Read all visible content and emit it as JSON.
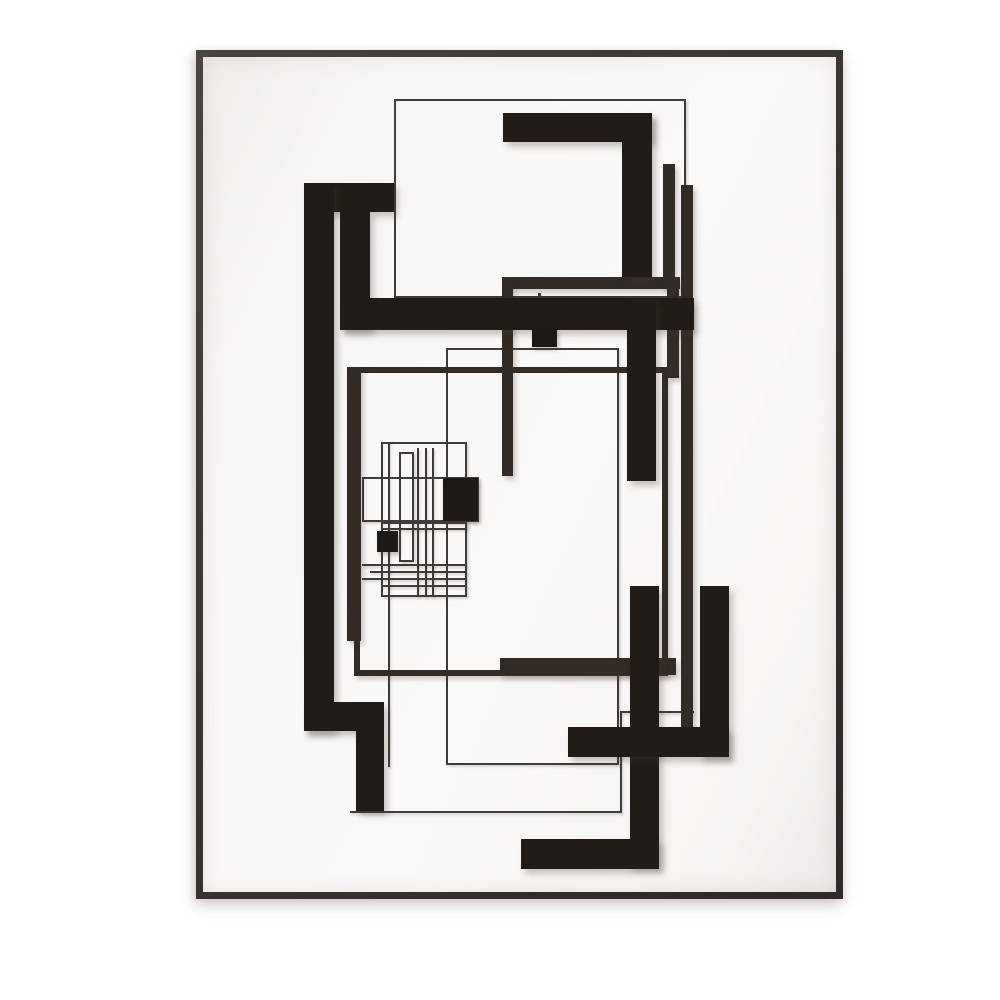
{
  "artwork": {
    "palette": {
      "background": "#ffffff",
      "matte": "#f8f6f4",
      "frame": "#3d3834",
      "thick": "#211c18",
      "medium": "#322b26",
      "thin": "#3f3b39",
      "accent_square": "#1e1915"
    },
    "frame": {
      "x": 196,
      "y": 50,
      "width": 647,
      "height": 849,
      "thickness": 7
    },
    "shapes": [
      {
        "name": "outline-square-top",
        "kind": "thin-outline",
        "x": 394,
        "y": 99,
        "w": 292,
        "h": 199,
        "t": 2
      },
      {
        "name": "outline-rect-center",
        "kind": "thin-outline",
        "x": 446,
        "y": 348,
        "w": 173,
        "h": 417,
        "t": 2
      },
      {
        "name": "cluster-outer-rect",
        "kind": "thin-outline",
        "x": 381,
        "y": 442,
        "w": 86,
        "h": 88,
        "t": 2
      },
      {
        "name": "cluster-tall-rect",
        "kind": "thin-outline",
        "x": 399,
        "y": 452,
        "w": 15,
        "h": 110,
        "t": 2
      },
      {
        "name": "cluster-wide-rect",
        "kind": "thin-outline",
        "x": 362,
        "y": 477,
        "w": 117,
        "h": 45,
        "t": 2
      },
      {
        "name": "cluster-lower-rect",
        "kind": "thin-outline",
        "x": 381,
        "y": 522,
        "w": 86,
        "h": 75,
        "t": 2
      },
      {
        "name": "thin-line-bottom",
        "kind": "thin-line",
        "x": 350,
        "y": 811,
        "w": 272,
        "h": 2
      },
      {
        "name": "thin-line-right-vertical",
        "kind": "thin-line",
        "x": 620,
        "y": 712,
        "w": 2,
        "h": 100
      },
      {
        "name": "thin-line-right-horizontal",
        "kind": "thin-line",
        "x": 620,
        "y": 711,
        "w": 74,
        "h": 2
      },
      {
        "name": "thin-line-left-vertical",
        "kind": "thin-line",
        "x": 388,
        "y": 442,
        "w": 2,
        "h": 325
      },
      {
        "name": "thin-connector-top",
        "kind": "thin-line",
        "x": 538,
        "y": 293,
        "w": 3,
        "h": 36
      },
      {
        "name": "cluster-vline-1",
        "kind": "thin-line",
        "x": 417,
        "y": 448,
        "w": 2,
        "h": 149
      },
      {
        "name": "cluster-vline-2",
        "kind": "thin-line",
        "x": 425,
        "y": 448,
        "w": 2,
        "h": 149
      },
      {
        "name": "cluster-vline-3",
        "kind": "thin-line",
        "x": 432,
        "y": 448,
        "w": 2,
        "h": 149
      },
      {
        "name": "cluster-hline-1",
        "kind": "thin-line",
        "x": 362,
        "y": 564,
        "w": 105,
        "h": 2
      },
      {
        "name": "cluster-hline-2",
        "kind": "thin-line",
        "x": 370,
        "y": 571,
        "w": 97,
        "h": 2
      },
      {
        "name": "cluster-hline-3",
        "kind": "thin-line",
        "x": 362,
        "y": 578,
        "w": 105,
        "h": 2
      },
      {
        "name": "cluster-hline-4",
        "kind": "thin-line",
        "x": 381,
        "y": 585,
        "w": 86,
        "h": 2
      },
      {
        "name": "medium-rect-frame",
        "kind": "medium-outline",
        "x": 354,
        "y": 367,
        "w": 314,
        "h": 309,
        "t": 6
      },
      {
        "name": "medium-left-bar",
        "kind": "medium-bar",
        "x": 347,
        "y": 367,
        "w": 14,
        "h": 274
      },
      {
        "name": "medium-zigzag-horizontal",
        "kind": "medium-bar",
        "x": 502,
        "y": 277,
        "w": 178,
        "h": 12
      },
      {
        "name": "medium-zigzag-down-left",
        "kind": "medium-bar",
        "x": 502,
        "y": 285,
        "w": 11,
        "h": 191
      },
      {
        "name": "medium-zigzag-up-right",
        "kind": "medium-bar",
        "x": 663,
        "y": 164,
        "w": 12,
        "h": 124
      },
      {
        "name": "medium-zigzag-down-right",
        "kind": "medium-bar",
        "x": 667,
        "y": 288,
        "w": 12,
        "h": 90
      },
      {
        "name": "medium-long-vertical",
        "kind": "medium-bar",
        "x": 681,
        "y": 185,
        "w": 12,
        "h": 542
      },
      {
        "name": "medium-bottom-horizontal",
        "kind": "medium-bar",
        "x": 500,
        "y": 658,
        "w": 176,
        "h": 17
      },
      {
        "name": "thick-top-left-bar",
        "kind": "thick-bar",
        "x": 312,
        "y": 183,
        "w": 82,
        "h": 29
      },
      {
        "name": "thick-left-tall-bar",
        "kind": "thick-bar",
        "x": 304,
        "y": 183,
        "w": 30,
        "h": 548
      },
      {
        "name": "thick-inner-vertical",
        "kind": "thick-bar",
        "x": 340,
        "y": 211,
        "w": 30,
        "h": 119
      },
      {
        "name": "thick-main-horizontal",
        "kind": "thick-bar",
        "x": 340,
        "y": 298,
        "w": 354,
        "h": 32
      },
      {
        "name": "thick-c-top-bar",
        "kind": "thick-bar",
        "x": 503,
        "y": 113,
        "w": 149,
        "h": 29
      },
      {
        "name": "thick-c-right-vertical",
        "kind": "thick-bar",
        "x": 622,
        "y": 113,
        "w": 30,
        "h": 164
      },
      {
        "name": "thick-mid-vertical",
        "kind": "thick-bar",
        "x": 627,
        "y": 298,
        "w": 29,
        "h": 183
      },
      {
        "name": "thick-step-horizontal",
        "kind": "thick-bar",
        "x": 304,
        "y": 702,
        "w": 80,
        "h": 29
      },
      {
        "name": "thick-step-vertical",
        "kind": "thick-bar",
        "x": 356,
        "y": 731,
        "w": 28,
        "h": 80
      },
      {
        "name": "thick-right-tall-vertical",
        "kind": "thick-bar",
        "x": 630,
        "y": 586,
        "w": 29,
        "h": 280
      },
      {
        "name": "thick-bottom-bar",
        "kind": "thick-bar",
        "x": 521,
        "y": 839,
        "w": 138,
        "h": 30
      },
      {
        "name": "thick-lower-horizontal",
        "kind": "thick-bar",
        "x": 568,
        "y": 727,
        "w": 161,
        "h": 30
      },
      {
        "name": "thick-right-vertical",
        "kind": "thick-bar",
        "x": 700,
        "y": 586,
        "w": 29,
        "h": 171
      },
      {
        "name": "small-black-square-top",
        "kind": "black-square",
        "x": 532,
        "y": 328,
        "w": 25,
        "h": 19
      },
      {
        "name": "cluster-black-square-right",
        "kind": "black-square",
        "x": 443,
        "y": 478,
        "w": 35,
        "h": 43
      },
      {
        "name": "cluster-black-square-left",
        "kind": "black-square",
        "x": 377,
        "y": 531,
        "w": 21,
        "h": 21
      }
    ]
  }
}
